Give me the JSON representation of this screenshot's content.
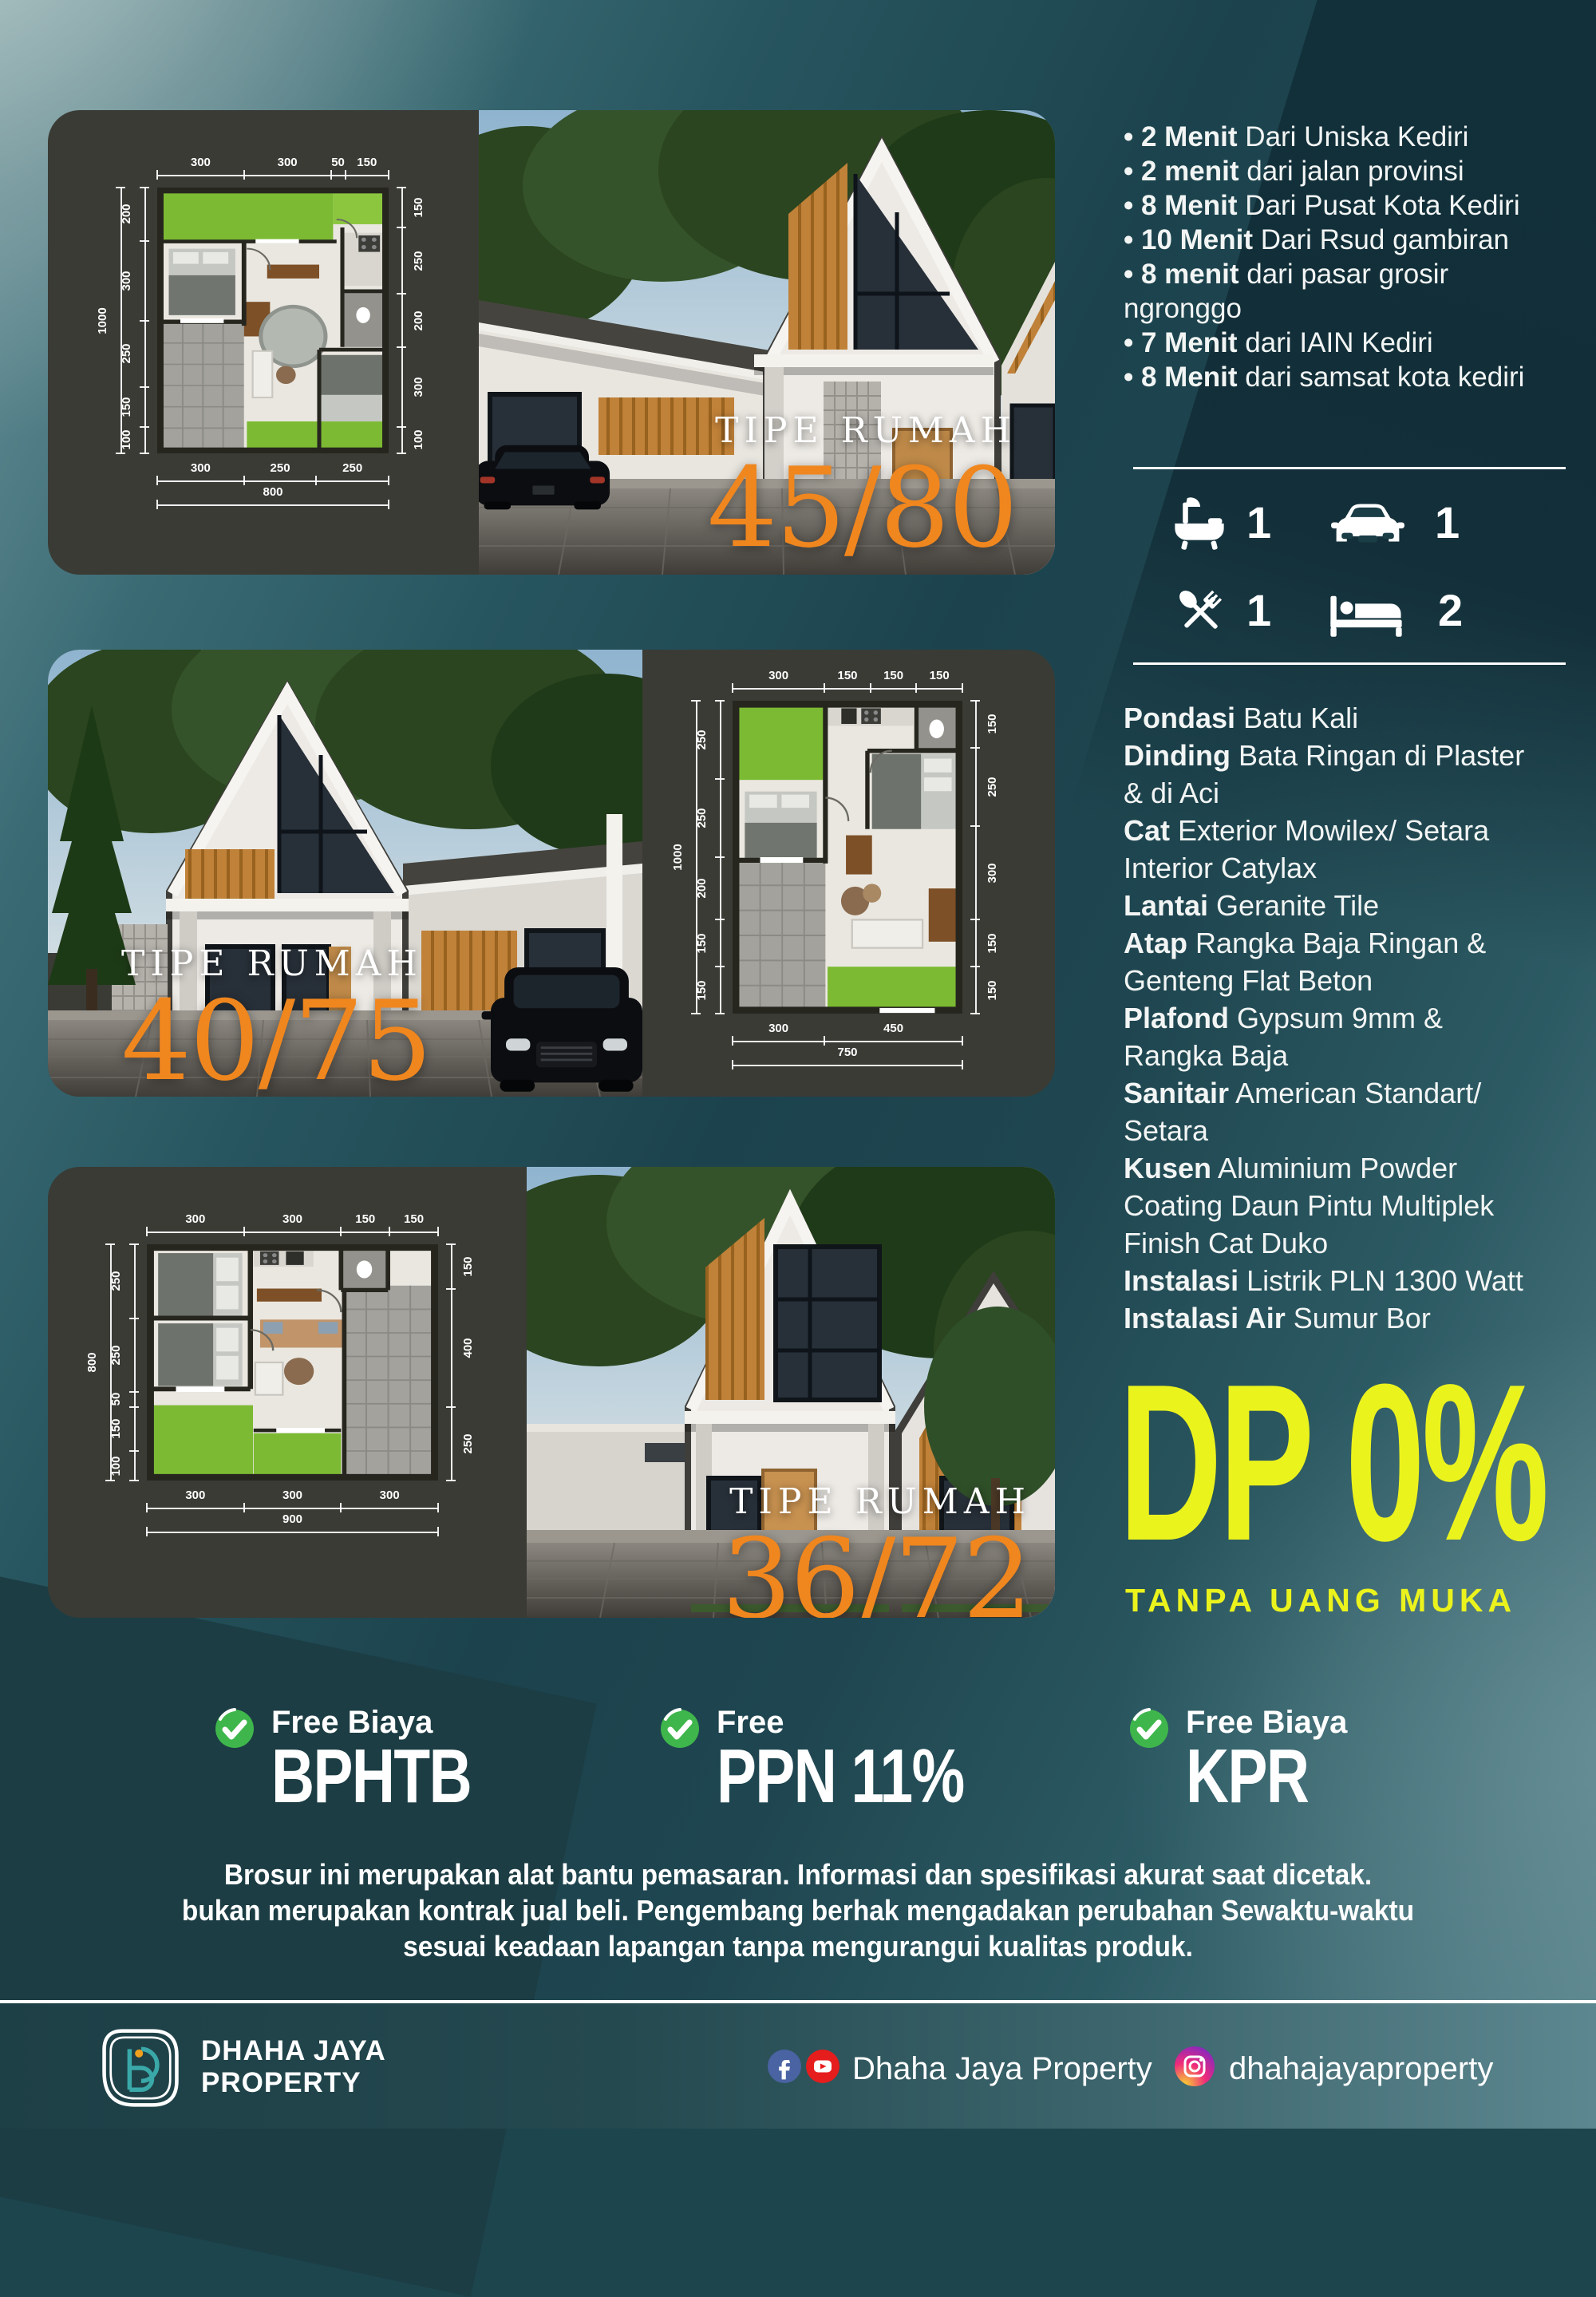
{
  "cards": [
    {
      "tipe_label": "TIPE RUMAH",
      "size": "45/80",
      "plan": {
        "top": [
          "300",
          "300",
          "50",
          "150"
        ],
        "left_total": "1000",
        "left": [
          "200",
          "300",
          "250",
          "150",
          "100"
        ],
        "right": [
          "150",
          "250",
          "200",
          "300",
          "100"
        ],
        "bottom": [
          "300",
          "250",
          "250"
        ],
        "bottom_total": "800"
      }
    },
    {
      "tipe_label": "TIPE RUMAH",
      "size": "40/75",
      "plan": {
        "top": [
          "300",
          "150",
          "150",
          "150"
        ],
        "left_total": "1000",
        "left": [
          "250",
          "250",
          "200",
          "150",
          "150"
        ],
        "right": [
          "150",
          "250",
          "300",
          "150",
          "150"
        ],
        "bottom": [
          "300",
          "450"
        ],
        "bottom_total": "750"
      }
    },
    {
      "tipe_label": "TIPE RUMAH",
      "size": "36/72",
      "plan": {
        "top": [
          "300",
          "300",
          "150",
          "150"
        ],
        "left_total": "800",
        "left": [
          "250",
          "250",
          "50",
          "150",
          "100"
        ],
        "right": [
          "150",
          "400",
          "250"
        ],
        "bottom": [
          "300",
          "300",
          "300"
        ],
        "bottom_total": "900"
      }
    }
  ],
  "location_points": [
    {
      "bold": "2 Menit",
      "rest": " Dari Uniska Kediri"
    },
    {
      "bold": "2 menit",
      "rest": " dari jalan provinsi"
    },
    {
      "bold": "8 Menit",
      "rest": " Dari Pusat Kota Kediri"
    },
    {
      "bold": "10 Menit",
      "rest": " Dari Rsud gambiran"
    },
    {
      "bold": "8 menit",
      "rest": " dari pasar grosir ngronggo"
    },
    {
      "bold": "7 Menit",
      "rest": " dari IAIN Kediri"
    },
    {
      "bold": "8  Menit",
      "rest": " dari samsat kota kediri"
    }
  ],
  "amenities": [
    {
      "icon": "bathtub-icon",
      "count": "1"
    },
    {
      "icon": "car-icon",
      "count": "1"
    },
    {
      "icon": "utensils-icon",
      "count": "1"
    },
    {
      "icon": "bed-icon",
      "count": "2"
    }
  ],
  "specs": [
    {
      "bold": "Pondasi",
      "rest": " Batu Kali"
    },
    {
      "bold": "Dinding",
      "rest": " Bata Ringan di Plaster & di Aci"
    },
    {
      "bold": "Cat",
      "rest": " Exterior Mowilex/ Setara Interior Catylax"
    },
    {
      "bold": "Lantai",
      "rest": " Geranite Tile"
    },
    {
      "bold": "Atap",
      "rest": " Rangka Baja Ringan & Genteng Flat Beton"
    },
    {
      "bold": "Plafond",
      "rest": " Gypsum 9mm & Rangka Baja"
    },
    {
      "bold": "Sanitair",
      "rest": " American Standart/ Setara"
    },
    {
      "bold": "Kusen",
      "rest": " Aluminium Powder Coating Daun Pintu Multiplek Finish Cat Duko"
    },
    {
      "bold": "Instalasi",
      "rest": " Listrik PLN 1300 Watt"
    },
    {
      "bold": "Instalasi Air",
      "rest": " Sumur Bor"
    }
  ],
  "promo": {
    "dp": "DP 0%",
    "subtitle": "TANPA UANG MUKA"
  },
  "benefits": [
    {
      "line1": "Free Biaya",
      "line2": "BPHTB"
    },
    {
      "line1": "Free",
      "line2": "PPN 11%"
    },
    {
      "line1": "Free Biaya",
      "line2": "KPR"
    }
  ],
  "disclaimer": [
    "Brosur ini merupakan alat bantu pemasaran. Informasi dan spesifikasi akurat saat dicetak.",
    "bukan merupakan kontrak jual beli. Pengembang berhak mengadakan perubahan Sewaktu-waktu",
    "sesuai keadaan lapangan tanpa mengurangui kualitas produk."
  ],
  "footer": {
    "brand_line1": "DHAHA JAYA",
    "brand_line2": "PROPERTY",
    "fb_yt_handle": "Dhaha Jaya Property",
    "ig_handle": "dhahajayaproperty"
  },
  "colors": {
    "accent_orange": "#f0861e",
    "accent_yellow": "#ebf31d",
    "check_green": "#3fb64c",
    "card_bg": "#3a3b35",
    "teal_dark": "#17353d",
    "teal_mid": "#2b5a63",
    "teal_light": "#a7bcba"
  }
}
